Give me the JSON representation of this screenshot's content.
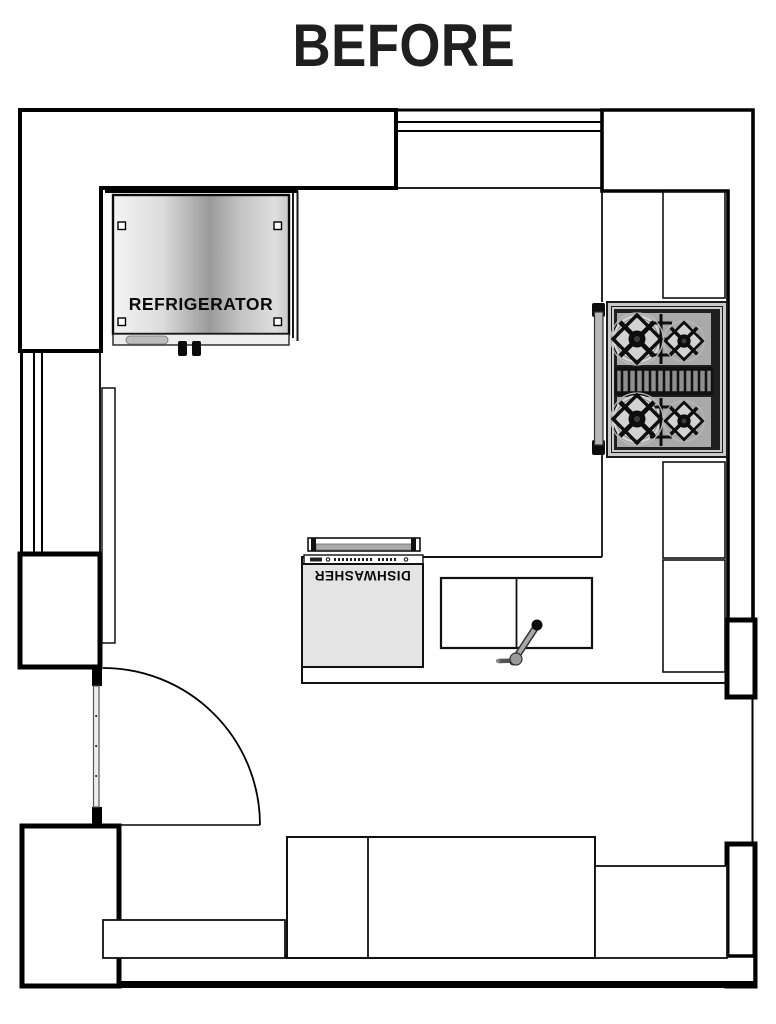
{
  "title": "BEFORE",
  "labels": {
    "refrigerator": "REFRIGERATOR",
    "dishwasher": "DISHWASHER"
  },
  "colors": {
    "line": "#000000",
    "background": "#ffffff",
    "stove_frame": "#c9c9c9",
    "stove_body": "#1f1f1f",
    "burner_zone": "#a9a9a9",
    "dishwasher_body": "#e4e4e4",
    "stainless_light": "#f4f4f4",
    "stainless_dark": "#9a9a9a"
  }
}
